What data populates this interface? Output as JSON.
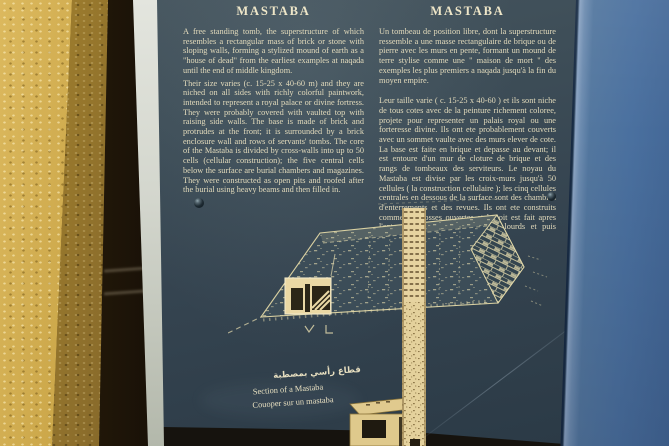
{
  "sign": {
    "english": {
      "title": "MASTABA",
      "para1": "A free standing tomb, the superstructure of which resembles a rectangular mass of brick or stone with sloping walls, forming a stylized mound of earth as a \"house of dead\" from the earliest examples at naqada until the end of middle kingdom.",
      "para2": "Their size varies (c. 15-25 x 40-60 m) and they are niched on all sides with richly colorful paintwork, intended to represent a royal palace or divine fortress. They were probably covered with vaulted top with raising side walls. The base is made of brick and protrudes at the front; it is surrounded by a brick enclosure wall and rows of servants' tombs. The core of the Mastaba is divided by cross-walls into up to 50 cells (cellular construction); the five central cells below the surface are burial chambers and magazines. They were constructed as open pits and roofed after the burial using heavy beams and then filled in."
    },
    "french": {
      "title": "MASTABA",
      "para1": "Un tombeau de position libre, dont la superstructure ressemble a une masse rectangulaire de brique ou de pierre avec les murs en pente, formant un mound de terre stylise comme une \" maison de mort \" des exemples les plus premiers a naqada jusqu'à la fin du moyen empire.",
      "para2": "Leur taille varie ( c. 15-25 x 40-60 ) et ils sont niche de tous cotes avec de la peinture richement coloree, projete pour representer un palais royal ou une forteresse divine. Ils ont ete probablement couverts avec un sommet vaulte avec des murs elever de cote. La base est faite en brique et depasse au devant; il est entoure d'un mur de cloture de brique et des rangs de tombeaux des serviteurs. Le noyau du Mastaba est divise par les croix-murs jusqu'à 50 cellules ( la construction cellulaire ); les cinq cellules centrales en dessous de la surface sont des chambres d'enterrements et des revues. Ils ont ete construits comme des fosses ouvertes et le toit est fait apres l'enterrement utilisant des rayons lourds et puis remplis."
    },
    "diagram_caption": {
      "arabic": "قطاع رأسي بمصطبة",
      "english": "Section of a Mastaba",
      "french": "Couoper sur un mastaba"
    },
    "colors": {
      "sign_panel": "#3a4a55",
      "sign_panel_dark": "#2b3a46",
      "sign_text": "#e6debf",
      "side_panel_blue": "#4a709f",
      "wall_yellow": "#cda84b",
      "diagram_gold": "#e6d3a0"
    }
  }
}
